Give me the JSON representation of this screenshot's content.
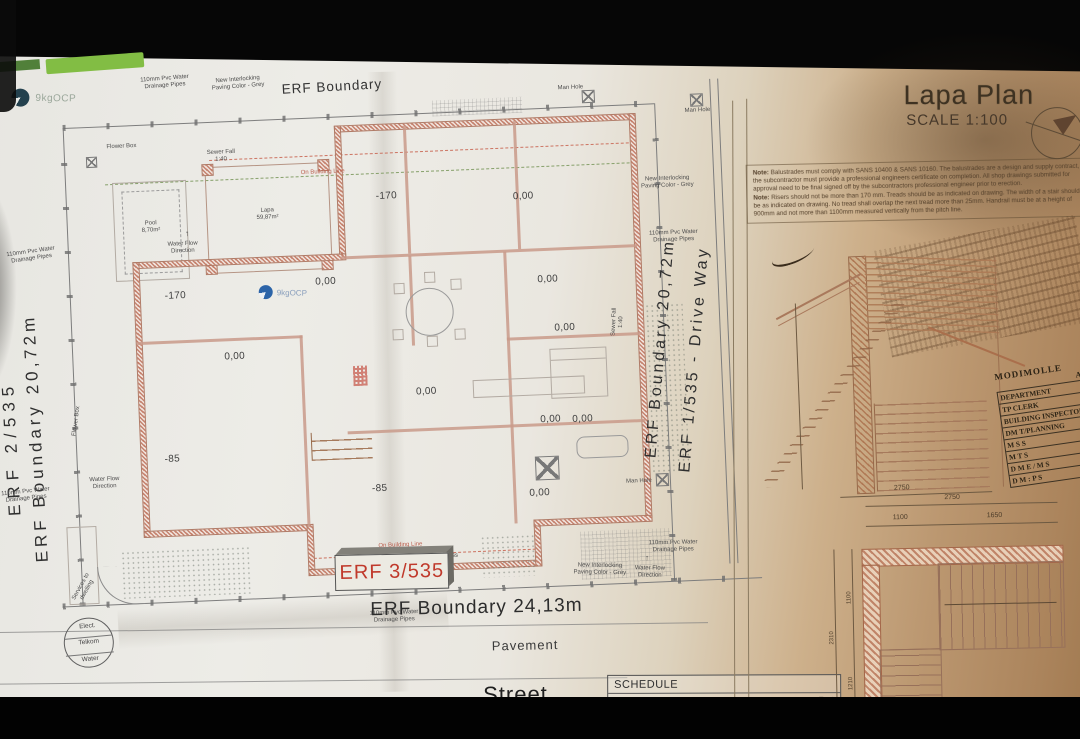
{
  "watermark": {
    "text": "9kgOCP"
  },
  "site": {
    "boundary_top": "ERF Boundary",
    "boundary_bottom": "ERF Boundary 24,13m",
    "stand_left": "ERF 2/535",
    "boundary_left": "ERF Boundary 20,72m",
    "boundary_right": "ERF Boundary 20,72m",
    "stand_right": "ERF 1/535 - Drive Way",
    "stand_number": "ERF 3/535",
    "pavement": "Pavement",
    "street": "Street"
  },
  "levels": {
    "minus170": "-170",
    "zero": "0,00",
    "minus85": "-85"
  },
  "features": {
    "pool_name": "Pool",
    "pool_area": "8,70m²",
    "lapa_name": "Lapa",
    "lapa_area": "59,87m²",
    "grass": "Grass",
    "flower_box": "Flower Box",
    "man_hole": "Man Hole",
    "sewer_fall": "Sewer Fall 1:40",
    "water_flow": "Water Flow Direction",
    "drainage_pipes": "110mm Pvc Water Drainage Pipes",
    "paving": "New Interlocking Paving Color - Grey",
    "building_line": "On Building Line",
    "services": "Services to dwelling",
    "utility_1": "Elect.",
    "utility_2": "Telkom",
    "utility_3": "Water",
    "flow_arrow": "↑"
  },
  "title_block": {
    "title": "Lapa Plan",
    "scale": "SCALE 1:100"
  },
  "notes": {
    "heading": "Note:",
    "note1": "Balustrades must comply with SANS 10400 & SANS 10160. The balustrades are a design and supply contract, the subcontractor must provide a professional engineers certificate on completion. All shop drawings submitted for approval need to be final signed off by the subcontractors professional engineer prior to erection.",
    "note2": "Risers should not be more than 170 mm. Treads should be as indicated on drawing. The width of a stair should be as indicated on drawing. No tread shall overlap the next tread more than 25mm. Handrail must be at a height of 900mm and not more than 1100mm measured vertically from the pitch line."
  },
  "approval": {
    "header": "MODIMOLLE",
    "subheader": "APPROVAL",
    "rows": [
      "DEPARTMENT",
      "TP CLERK",
      "BUILDING INSPECTOR",
      "DM T/PLANNING",
      "M S S",
      "M T S",
      "D M E / M S",
      "D M : P S"
    ]
  },
  "stair_plan": {
    "dim_total_width": "2750",
    "dim_width_a": "1100",
    "dim_width_b": "1650",
    "dim_total_height": "2310",
    "dim_height_a": "1100",
    "dim_height_b": "1210",
    "section_dim": "2750"
  },
  "schedule": {
    "title": "SCHEDULE",
    "row_label": "ERF AREA",
    "row_value": "= 499,97m²"
  }
}
